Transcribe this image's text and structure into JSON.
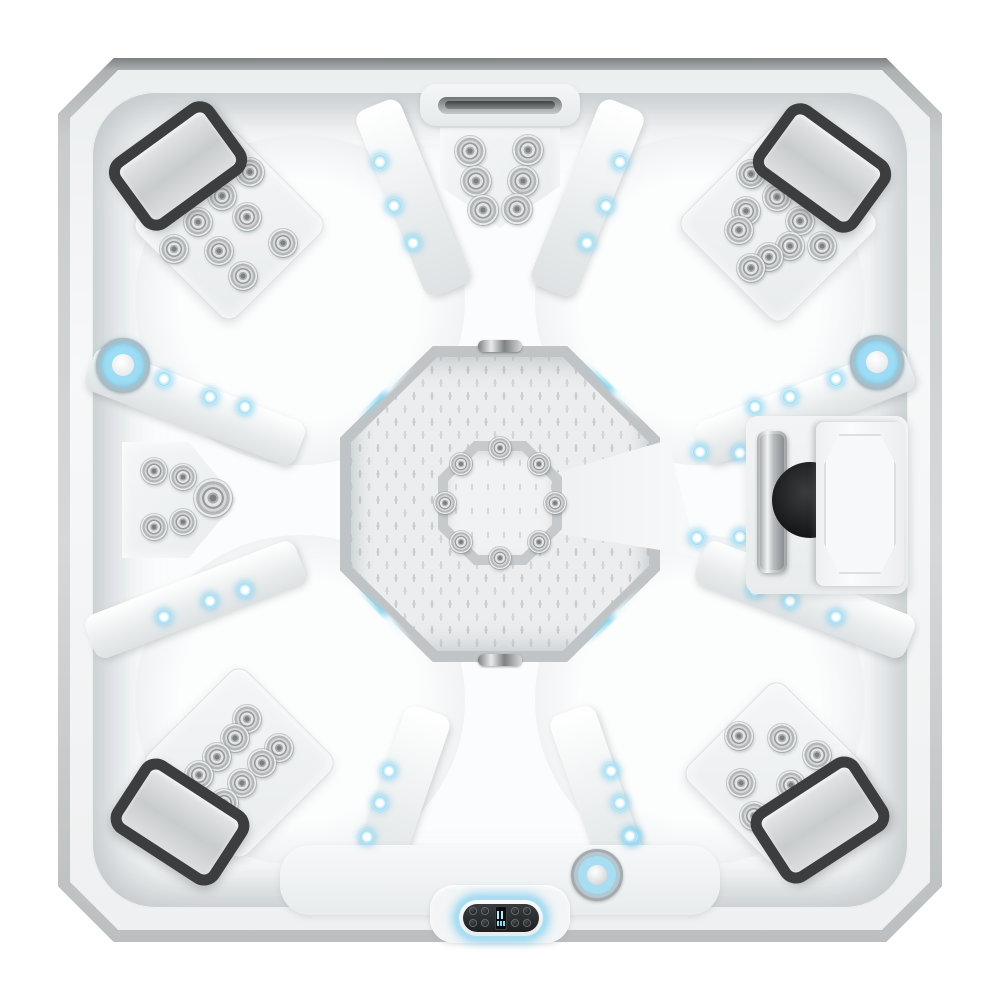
{
  "image": {
    "kind": "product-photo",
    "subject": "Top-down overhead view of a square white acrylic hot tub spa with four headrest pillows, hydrotherapy jet clusters, blue LED accent lighting, an octagonal wave-textured footwell with central foot blaster, a waterfall spout, a speaker compartment with sliding cover, a suction fitting and a topside control panel",
    "background": "#ffffff"
  },
  "palette": {
    "cabinet_edge": "#7e8182",
    "shell_white": "#fbfcfd",
    "shell_shadow": "#dfe2e4",
    "panel_gray": "#eff1f2",
    "octagon_rim": "#c0c4c6",
    "floor_texture": "#c9cdcf",
    "headrest_rim": "#3b3d3e",
    "headrest_pad": "#d2d4d5",
    "jet_chrome": "#b4b7b9",
    "led_blue": "#9adcf4",
    "accent_blue": "#9edcf4",
    "speaker_dark": "#151617",
    "control_glow": "#a6dff4",
    "control_face": "#1e2022"
  },
  "features": {
    "headrest_count": 4,
    "jet_cluster_count": 7,
    "total_jets": 50,
    "led_point_count": 29,
    "accent_ring_light_count": 2,
    "waterfall": "linear waterfall spout, top center",
    "footwell": "octagonal footwell, wave-textured floor, central octagonal foot blaster with 8 jets",
    "speaker_compartment": "right-side compartment, chrome handle, dark speaker cone behind sliding white door",
    "suction_fitting": "round chrome fitting with blue light ring, bottom center",
    "control_panel": "oval topside control pad with glowing blue rim, bottom center"
  },
  "headrests": [
    {
      "corner": "top-left",
      "x": 178,
      "y": 166,
      "angle": -36
    },
    {
      "corner": "top-right",
      "x": 822,
      "y": 168,
      "angle": 36
    },
    {
      "corner": "bottom-left",
      "x": 180,
      "y": 822,
      "angle": 33
    },
    {
      "corner": "bottom-right",
      "x": 820,
      "y": 820,
      "angle": -33
    }
  ],
  "jets": {
    "clusters": [
      {
        "id": "top-left-seat",
        "points": [
          [
            250,
            172,
            14
          ],
          [
            222,
            196,
            14
          ],
          [
            247,
            217,
            14
          ],
          [
            198,
            222,
            14
          ],
          [
            283,
            243,
            14
          ],
          [
            174,
            249,
            14
          ],
          [
            219,
            251,
            14
          ],
          [
            243,
            276,
            14
          ]
        ]
      },
      {
        "id": "top-right-seat",
        "points": [
          [
            751,
            174,
            14
          ],
          [
            777,
            197,
            14
          ],
          [
            746,
            211,
            14
          ],
          [
            800,
            221,
            14
          ],
          [
            739,
            230,
            14
          ],
          [
            790,
            246,
            14
          ],
          [
            822,
            246,
            14
          ],
          [
            769,
            257,
            14
          ],
          [
            751,
            268,
            14
          ]
        ]
      },
      {
        "id": "bottom-left-seat",
        "points": [
          [
            247,
            719,
            14
          ],
          [
            235,
            738,
            14
          ],
          [
            279,
            748,
            14
          ],
          [
            217,
            757,
            14
          ],
          [
            262,
            763,
            14
          ],
          [
            199,
            775,
            14
          ],
          [
            242,
            783,
            14
          ],
          [
            224,
            803,
            14
          ]
        ]
      },
      {
        "id": "bottom-right-seat",
        "points": [
          [
            739,
            736,
            14
          ],
          [
            782,
            738,
            14
          ],
          [
            817,
            755,
            14
          ],
          [
            741,
            783,
            14
          ],
          [
            791,
            785,
            14
          ],
          [
            754,
            816,
            14
          ]
        ]
      },
      {
        "id": "top-center-seat",
        "points": [
          [
            470,
            151,
            15
          ],
          [
            528,
            150,
            15
          ],
          [
            476,
            181,
            15
          ],
          [
            523,
            181,
            15
          ],
          [
            483,
            210,
            15
          ],
          [
            517,
            209,
            15
          ]
        ]
      },
      {
        "id": "left-lounge",
        "points": [
          [
            154,
            471,
            13
          ],
          [
            183,
            477,
            13
          ],
          [
            213,
            498,
            19
          ],
          [
            183,
            522,
            13
          ],
          [
            154,
            527,
            13
          ]
        ]
      },
      {
        "id": "foot-blaster-ring",
        "points": [
          [
            500,
            448,
            11
          ],
          [
            539,
            464,
            11
          ],
          [
            555,
            503,
            11
          ],
          [
            539,
            542,
            11
          ],
          [
            500,
            558,
            11
          ],
          [
            461,
            542,
            11
          ],
          [
            445,
            503,
            11
          ],
          [
            461,
            464,
            11
          ]
        ]
      }
    ]
  },
  "lighting": {
    "leds": [
      [
        164,
        379
      ],
      [
        210,
        397
      ],
      [
        245,
        407
      ],
      [
        380,
        162
      ],
      [
        394,
        206
      ],
      [
        413,
        243
      ],
      [
        620,
        162
      ],
      [
        606,
        206
      ],
      [
        587,
        243
      ],
      [
        836,
        379
      ],
      [
        790,
        397
      ],
      [
        755,
        407
      ],
      [
        164,
        617
      ],
      [
        210,
        601
      ],
      [
        245,
        590
      ],
      [
        389,
        771
      ],
      [
        380,
        803
      ],
      [
        367,
        837
      ],
      [
        611,
        771
      ],
      [
        620,
        803
      ],
      [
        633,
        837
      ],
      [
        836,
        617
      ],
      [
        790,
        601
      ],
      [
        755,
        590
      ],
      [
        740,
        453
      ],
      [
        740,
        537
      ],
      [
        700,
        452
      ],
      [
        697,
        538
      ],
      [
        630,
        836
      ]
    ],
    "accents": [
      [
        123,
        365
      ],
      [
        877,
        362
      ]
    ]
  },
  "control_panel": {
    "buttons_left": 4,
    "buttons_right": 4,
    "display": "segmented LCD, two rows",
    "glow_color": "#a6dff4"
  }
}
